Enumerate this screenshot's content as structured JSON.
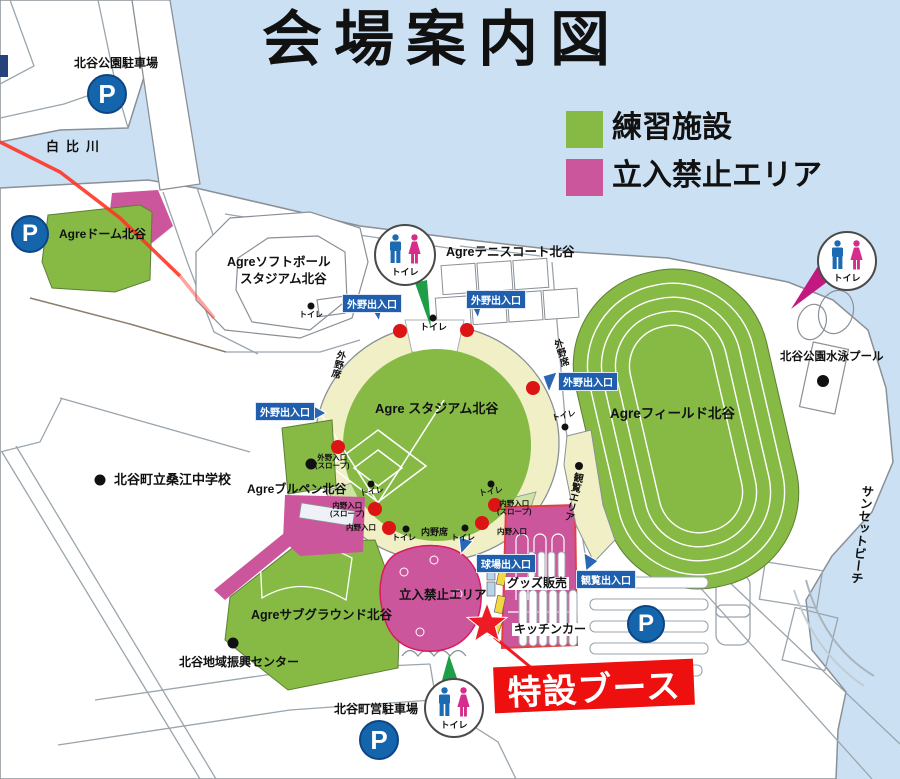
{
  "title": "会場案内図",
  "legend": {
    "practice": "練習施設",
    "no_entry": "立入禁止エリア"
  },
  "colors": {
    "practice_green": "#86ba45",
    "no_entry_pink": "#cc569c",
    "water_blue": "#cbe1f3",
    "gate_blue": "#1f5fae",
    "stand_cream": "#f1efc6",
    "alert_red": "#ee0f0f"
  },
  "facilities": {
    "park_parking": "北谷公園駐車場",
    "river": "白比川",
    "dome": "Agreドーム北谷",
    "softball1": "Agreソフトボール",
    "softball2": "スタジアム北谷",
    "tennis": "Agreテニスコート北谷",
    "stadium": "Agre スタジアム北谷",
    "field": "Agreフィールド北谷",
    "pool": "北谷公園水泳プール",
    "beach": "サンセットビーチ",
    "school": "北谷町立桑江中学校",
    "bullpen": "Agreブルペン北谷",
    "subground": "Agreサブグラウンド北谷",
    "community": "北谷地域振興センター",
    "town_parking": "北谷町営駐車場"
  },
  "gates": {
    "outfield_inout": "外野出入口",
    "outfield_in": "外野入口",
    "infield_in": "内野入口",
    "slope": "(スロープ)",
    "stadium_inout": "球場出入口",
    "viewing_inout": "観覧出入口",
    "viewing_area": "観覧エリア"
  },
  "seats": {
    "outfield": "外野席",
    "infield": "内野席"
  },
  "labels": {
    "toilet": "トイレ",
    "parking": "P"
  },
  "booth": {
    "special": "特設ブース",
    "goods": "グッズ販売",
    "kitchen": "キッチンカー",
    "no_entry": "立入禁止エリア"
  }
}
